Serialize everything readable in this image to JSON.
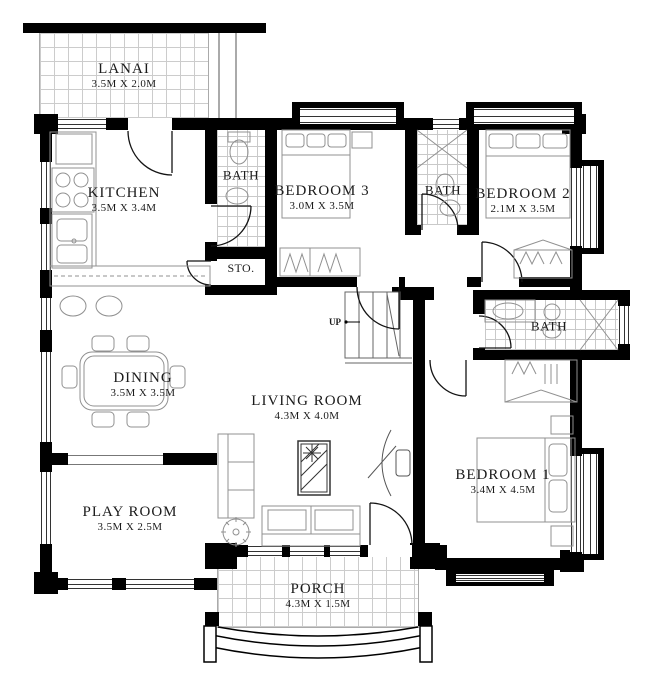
{
  "plan": {
    "title": "house-floor-plan",
    "stair_label": "UP",
    "rooms": {
      "lanai": {
        "name": "LANAI",
        "dims": "3.5M X 2.0M"
      },
      "kitchen": {
        "name": "KITCHEN",
        "dims": "3.5M X 3.4M"
      },
      "bath_top": {
        "name": "BATH"
      },
      "storage": {
        "name": "STO."
      },
      "bedroom3": {
        "name": "BEDROOM 3",
        "dims": "3.0M X 3.5M"
      },
      "bath_mid": {
        "name": "BATH"
      },
      "bedroom2": {
        "name": "BEDROOM 2",
        "dims": "2.1M X 3.5M"
      },
      "dining": {
        "name": "DINING",
        "dims": "3.5M X 3.5M"
      },
      "living": {
        "name": "LIVING ROOM",
        "dims": "4.3M X 4.0M"
      },
      "bath_master": {
        "name": "BATH"
      },
      "bedroom1": {
        "name": "BEDROOM 1",
        "dims": "3.4M X 4.5M"
      },
      "playroom": {
        "name": "PLAY ROOM",
        "dims": "3.5M X 2.5M"
      },
      "porch": {
        "name": "PORCH",
        "dims": "4.3M X 1.5M"
      }
    },
    "colors": {
      "wall": "#000000",
      "furniture_line": "#909090",
      "tile_line": "#cccccc",
      "background": "#ffffff",
      "text": "#1b1b1b"
    }
  }
}
